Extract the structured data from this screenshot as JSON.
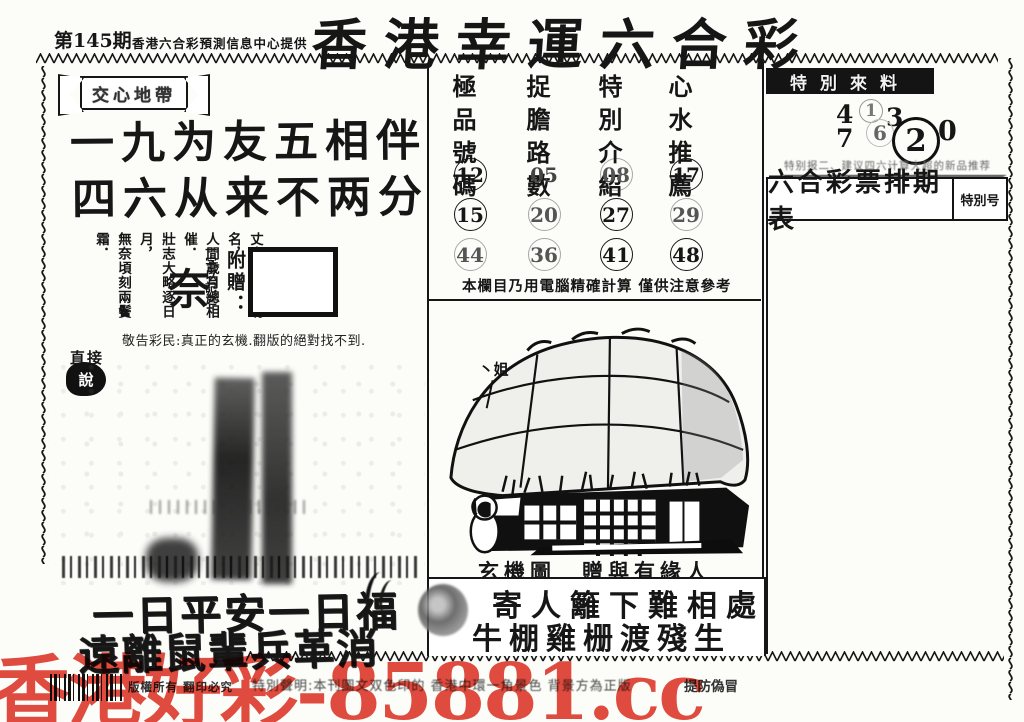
{
  "header": {
    "issue": "第145期",
    "provider": "香港六合彩預測信息中心提供",
    "title": "香港幸運六合彩"
  },
  "left_panel": {
    "ribbon": "交心地帶",
    "verse_line1": "一九为友五相伴",
    "verse_line2": "四六从来不两分",
    "poem_columns": [
      "丈夫處世立功名，",
      "人間歲月總相催．",
      "壯志大略逐日月，",
      "無奈頃刻兩鬢霜．"
    ],
    "big_char": "奈",
    "big_char_note": "一字以記之",
    "gift_label": "附贈：",
    "notice": "敬告彩民:真正的玄機.翻版的絕對找不到.",
    "badge_top": "直接",
    "badge_bottom": "說",
    "bottom_verse1": "一日平安一日福",
    "bottom_verse2": "遠離鼠輩兵革消"
  },
  "tips": {
    "columns": [
      {
        "header": "極品號碼",
        "numbers": [
          {
            "v": "12"
          },
          {
            "v": "15"
          },
          {
            "v": "44"
          }
        ]
      },
      {
        "header": "捉膽路數",
        "numbers": [
          {
            "v": "05"
          },
          {
            "v": "20"
          },
          {
            "v": "36"
          }
        ]
      },
      {
        "header": "特別介紹",
        "numbers": [
          {
            "v": "08"
          },
          {
            "v": "27"
          },
          {
            "v": "41"
          }
        ]
      },
      {
        "header": "心水推薦",
        "numbers": [
          {
            "v": "17"
          },
          {
            "v": "29"
          },
          {
            "v": "48"
          }
        ]
      }
    ],
    "note": "本欄目乃用電腦精確計算 僅供注意參考"
  },
  "mystery": {
    "roof_label": "丶姐",
    "caption": "玄機圖　贈與有緣人",
    "verse1": "寄人籬下難相處",
    "verse2": "牛棚雞栅渡殘生"
  },
  "right_panel": {
    "label": "特別來料",
    "numbers": {
      "n4": "4",
      "n7": "7",
      "n1": "1",
      "n3": "3",
      "n6": "6",
      "n2": "2",
      "n0": "0"
    },
    "small_note": "特别报二、建议四六计算大超的新品推荐",
    "schedule_title": "六合彩票排期表",
    "schedule_badge": "特別号"
  },
  "footer": {
    "copyright": "版權所有 翻印必究",
    "statement": "特別聲明:本刊圖文双色印的 香港中環一角景色 背景方為正版",
    "warning": "提防偽冒",
    "watermark": "香港好彩-85881.cc",
    "watermark_color": "#e03e30",
    "ink_color": "#161616"
  }
}
